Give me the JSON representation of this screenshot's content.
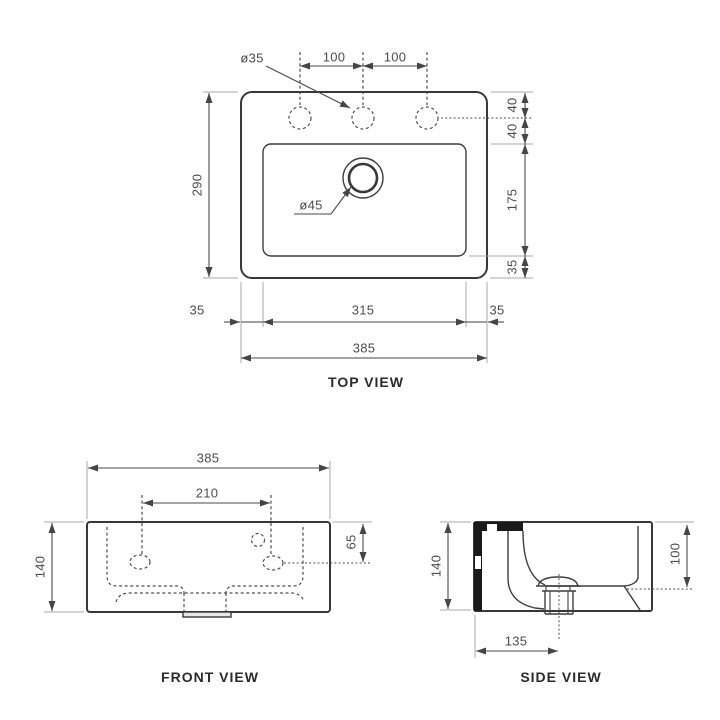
{
  "top_view": {
    "title": "TOP VIEW",
    "hole_diameter": "ø35",
    "drain_diameter": "ø45",
    "hole_spacing_left": "100",
    "hole_spacing_right": "100",
    "depth": "290",
    "edge_to_hole": "40",
    "hole_to_basin": "40",
    "basin_depth": "175",
    "basin_to_front": "35",
    "rim_left": "35",
    "basin_width": "315",
    "rim_right": "35",
    "total_width": "385"
  },
  "front_view": {
    "title": "FRONT VIEW",
    "total_width": "385",
    "fixing_hole_spacing": "210",
    "height": "140",
    "hole_drop": "65"
  },
  "side_view": {
    "title": "SIDE VIEW",
    "height": "140",
    "inner_depth": "100",
    "drain_offset": "135"
  },
  "colors": {
    "line": "#3f3f3f",
    "dimension_text": "#4d4d4d",
    "background": "#ffffff"
  }
}
